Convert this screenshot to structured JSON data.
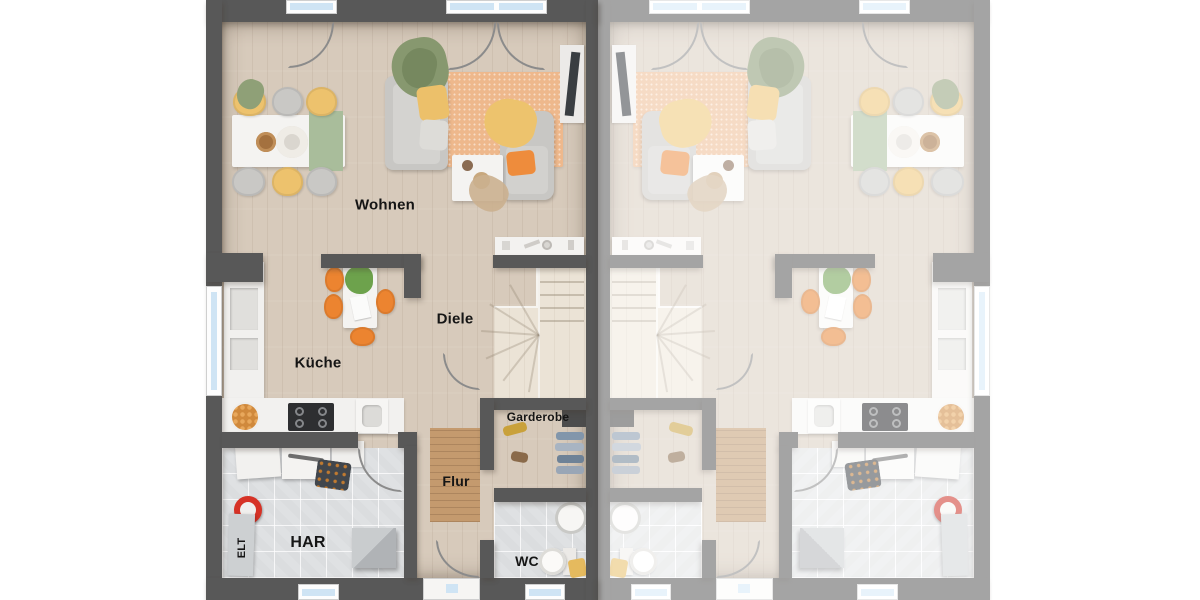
{
  "floorplan": {
    "description": "Ground floor plan of a semi-detached duplex; left unit labeled, right unit mirrored and faded",
    "rooms": {
      "wohnen": "Wohnen",
      "kueche": "Küche",
      "diele": "Diele",
      "garderobe": "Garderobe",
      "flur": "Flur",
      "har": "HAR",
      "wc": "WC",
      "elt": "ELT"
    },
    "colors": {
      "wall_dark": "#585858",
      "wall_faded": "#a6a6a6",
      "floor_wood": "#d7cabb",
      "floor_wood_light": "#ebe3d6",
      "floor_tile": "#dfe1e3",
      "rug_living": "#eeb88c",
      "runner_flur": "#c49a6e",
      "window_glass": "#cfe4f4",
      "accent_orange": "#ec8430",
      "accent_yellow": "#edc26d",
      "accent_green": "#87986f",
      "sofa_gray": "#c8c7c4"
    }
  }
}
